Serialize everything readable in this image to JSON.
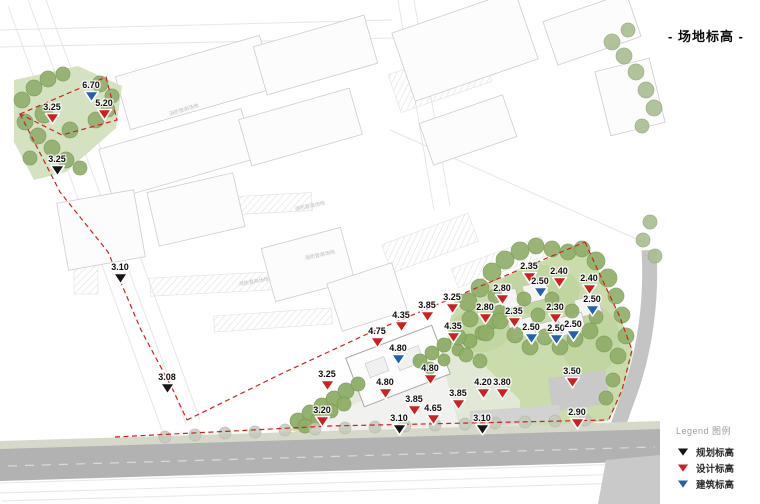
{
  "title": "- 场地标高 -",
  "legend": {
    "heading": "Legend 图例",
    "items": [
      {
        "label": "规划标高",
        "type": "planning"
      },
      {
        "label": "设计标高",
        "type": "design"
      },
      {
        "label": "建筑标高",
        "type": "building"
      }
    ]
  },
  "colors": {
    "planning": "#161616",
    "design": "#d11f1f",
    "building": "#2361ae",
    "boundary": "#cf2020"
  },
  "plan_labels": [
    {
      "text": "消防登高场地",
      "x": 168,
      "y": 110,
      "rot": -17
    },
    {
      "text": "消防登高场地",
      "x": 294,
      "y": 205,
      "rot": -12
    },
    {
      "text": "消防登高场地",
      "x": 304,
      "y": 254,
      "rot": -12
    },
    {
      "text": "消防登高场地",
      "x": 238,
      "y": 280,
      "rot": -10
    }
  ],
  "markers": [
    {
      "value": "3.25",
      "type": "design",
      "x": 52,
      "y": 102
    },
    {
      "value": "6.70",
      "type": "building",
      "x": 91,
      "y": 80
    },
    {
      "value": "5.20",
      "type": "design",
      "x": 104,
      "y": 98
    },
    {
      "value": "3.25",
      "type": "planning",
      "x": 57,
      "y": 154
    },
    {
      "value": "3.10",
      "type": "planning",
      "x": 120,
      "y": 262
    },
    {
      "value": "3.08",
      "type": "planning",
      "x": 167,
      "y": 372
    },
    {
      "value": "3.25",
      "type": "design",
      "x": 327,
      "y": 369
    },
    {
      "value": "3.20",
      "type": "design",
      "x": 322,
      "y": 405
    },
    {
      "value": "4.75",
      "type": "design",
      "x": 377,
      "y": 326
    },
    {
      "value": "4.35",
      "type": "design",
      "x": 401,
      "y": 310
    },
    {
      "value": "3.85",
      "type": "design",
      "x": 427,
      "y": 300
    },
    {
      "value": "3.25",
      "type": "design",
      "x": 452,
      "y": 292
    },
    {
      "value": "4.35",
      "type": "design",
      "x": 453,
      "y": 321
    },
    {
      "value": "4.80",
      "type": "building",
      "x": 398,
      "y": 343
    },
    {
      "value": "4.80",
      "type": "design",
      "x": 430,
      "y": 363
    },
    {
      "value": "4.80",
      "type": "design",
      "x": 385,
      "y": 377
    },
    {
      "value": "3.85",
      "type": "design",
      "x": 414,
      "y": 394
    },
    {
      "value": "4.65",
      "type": "design",
      "x": 433,
      "y": 403
    },
    {
      "value": "3.10",
      "type": "planning",
      "x": 399,
      "y": 413
    },
    {
      "value": "3.85",
      "type": "design",
      "x": 458,
      "y": 388
    },
    {
      "value": "4.20",
      "type": "design",
      "x": 483,
      "y": 377
    },
    {
      "value": "3.80",
      "type": "design",
      "x": 502,
      "y": 377
    },
    {
      "value": "3.10",
      "type": "planning",
      "x": 482,
      "y": 413
    },
    {
      "value": "3.50",
      "type": "design",
      "x": 572,
      "y": 366
    },
    {
      "value": "2.90",
      "type": "design",
      "x": 577,
      "y": 407
    },
    {
      "value": "2.35",
      "type": "design",
      "x": 529,
      "y": 261
    },
    {
      "value": "2.40",
      "type": "design",
      "x": 559,
      "y": 266
    },
    {
      "value": "2.40",
      "type": "design",
      "x": 589,
      "y": 273
    },
    {
      "value": "2.50",
      "type": "building",
      "x": 540,
      "y": 276
    },
    {
      "value": "2.80",
      "type": "design",
      "x": 502,
      "y": 283
    },
    {
      "value": "2.50",
      "type": "building",
      "x": 592,
      "y": 294
    },
    {
      "value": "2.80",
      "type": "design",
      "x": 485,
      "y": 302
    },
    {
      "value": "2.35",
      "type": "design",
      "x": 514,
      "y": 306
    },
    {
      "value": "2.30",
      "type": "design",
      "x": 555,
      "y": 302
    },
    {
      "value": "2.50",
      "type": "building",
      "x": 531,
      "y": 322
    },
    {
      "value": "2.50",
      "type": "building",
      "x": 556,
      "y": 323
    },
    {
      "value": "2.50",
      "type": "building",
      "x": 573,
      "y": 319
    }
  ]
}
